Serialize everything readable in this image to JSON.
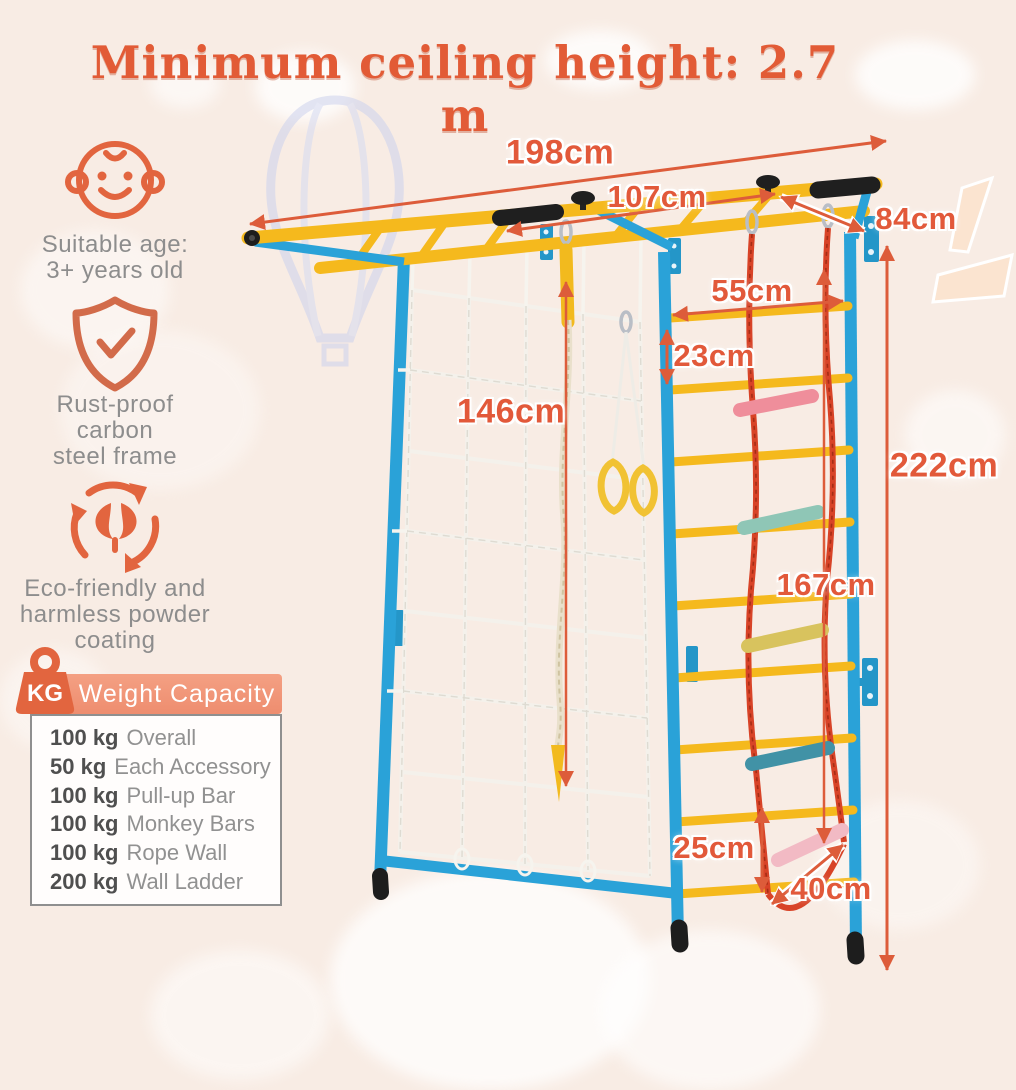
{
  "title": "Minimum ceiling height: 2.7 m",
  "features": [
    {
      "icon": "baby-icon",
      "lines": [
        "Suitable age:",
        "3+ years old"
      ]
    },
    {
      "icon": "shield-check-icon",
      "lines": [
        "Rust-proof",
        "carbon",
        "steel frame"
      ]
    },
    {
      "icon": "eco-recycle-icon",
      "lines": [
        "Eco-friendly and",
        "harmless powder",
        "coating"
      ]
    }
  ],
  "weight_capacity": {
    "icon": "kg-weight-icon",
    "icon_label": "KG",
    "title": "Weight Capacity",
    "rows": [
      {
        "value": "100 kg",
        "label": "Overall"
      },
      {
        "value": "50 kg",
        "label": "Each Accessory"
      },
      {
        "value": "100 kg",
        "label": "Pull-up Bar"
      },
      {
        "value": "100 kg",
        "label": "Monkey Bars"
      },
      {
        "value": "100 kg",
        "label": "Rope Wall"
      },
      {
        "value": "200 kg",
        "label": "Wall Ladder"
      }
    ]
  },
  "dimensions": [
    {
      "name": "total-width",
      "label": "198cm"
    },
    {
      "name": "monkey-bar-span",
      "label": "107cm"
    },
    {
      "name": "depth",
      "label": "84cm"
    },
    {
      "name": "ladder-width",
      "label": "55cm"
    },
    {
      "name": "rung-gap",
      "label": "23cm"
    },
    {
      "name": "climbing-rope",
      "label": "146cm"
    },
    {
      "name": "total-height",
      "label": "222cm"
    },
    {
      "name": "rope-ladder-length",
      "label": "167cm"
    },
    {
      "name": "bottom-rung-gap",
      "label": "25cm"
    },
    {
      "name": "rope-ladder-width",
      "label": "40cm"
    }
  ],
  "colors": {
    "background": "#f8ece4",
    "accent_orange": "#e2593a",
    "frame_blue": "#2aa2d8",
    "bar_yellow": "#f5b91d",
    "rope_red": "#d84327",
    "net_white": "#f4f2ec",
    "text_gray": "#8d8d8d",
    "capacity_header": "#f19077"
  }
}
